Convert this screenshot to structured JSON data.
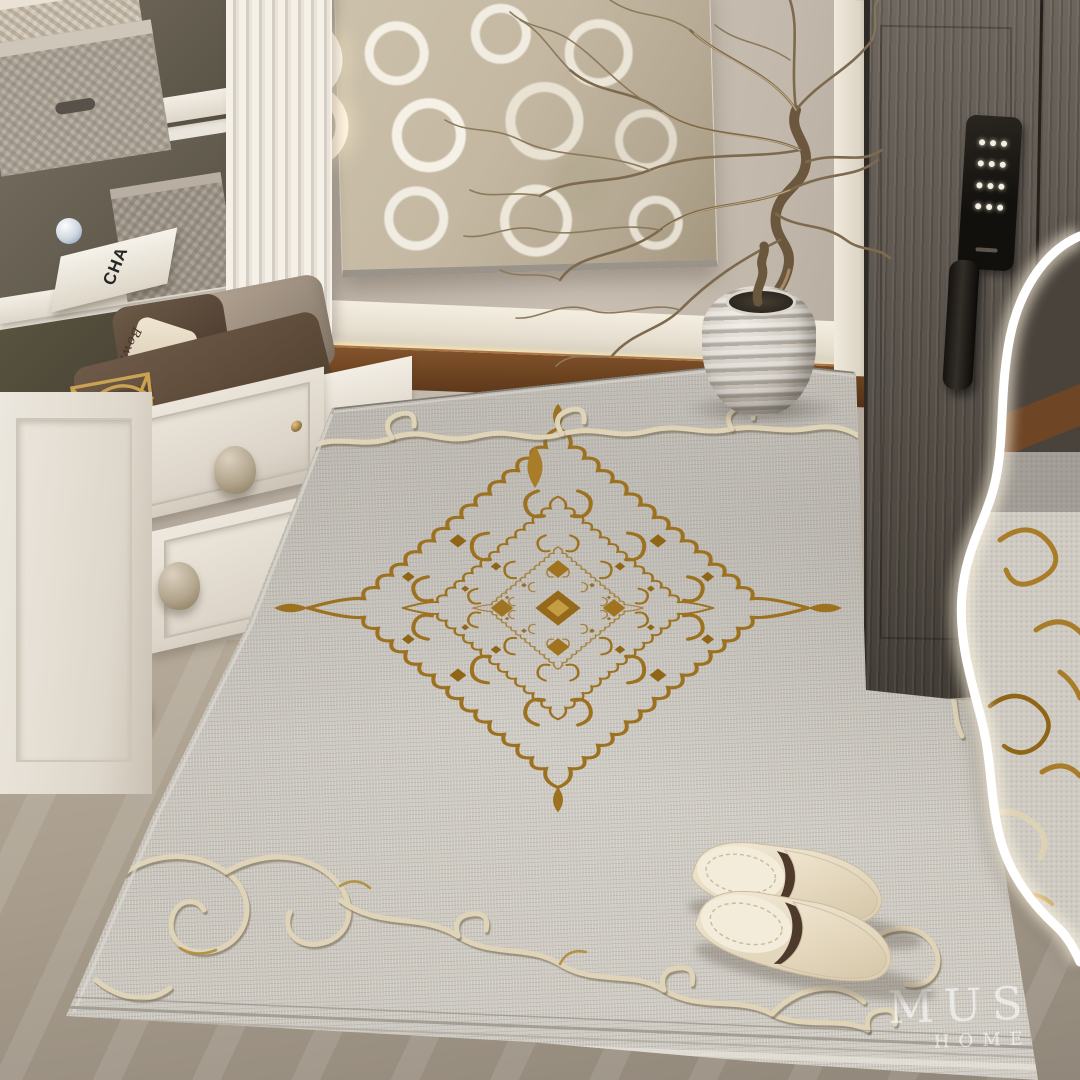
{
  "image": {
    "kind": "interior product photograph",
    "subject": "Light-gray chenille entryway rug with gold baroque medallion and cream scroll border, shown in a luxury hallway",
    "width_px": 1080,
    "height_px": 1080
  },
  "watermark": {
    "brand": "MUSE",
    "line2": "HOME"
  },
  "texts": {
    "book_spine": "CHA",
    "pillow_script": "Bowling"
  },
  "objects": {
    "rug": "gray rug with gold damask center medallion and embossed cream acanthus scroll border",
    "slippers": "pair of cream leather mule slippers with dark brown lining",
    "vase": "ribbed white ceramic vase holding a dried twisted-branch arrangement",
    "wall_art": "abstract beige canvas with white ring brushstrokes",
    "pendant_light": "two interlocked glowing LED rings with gold links",
    "door": "dark taupe entry door with black smart-lock keypad and pull handle",
    "left_furniture": "white shoe cabinet and bench with woven baskets, pillows and gold wire rack",
    "inset_panel": "wavy white-edged zoom detail of the rug pile along the right edge",
    "floors": "dark walnut wood strip at the wall, greige stone tile in front"
  },
  "palette": {
    "rug_base": "#c9c5bd",
    "rug_gold": "#a0741f",
    "rug_cream_scroll": "#e0d4b8",
    "wall": "#bdb3a7",
    "door": "#554e47",
    "wood_floor": "#6b421f",
    "tile_floor": "#a89d8c",
    "cabinet_white": "#ebe6dd",
    "led_glow": "#ffe9af",
    "lock_black": "#15120f",
    "watermark_white": "rgba(255,255,255,0.58)"
  }
}
